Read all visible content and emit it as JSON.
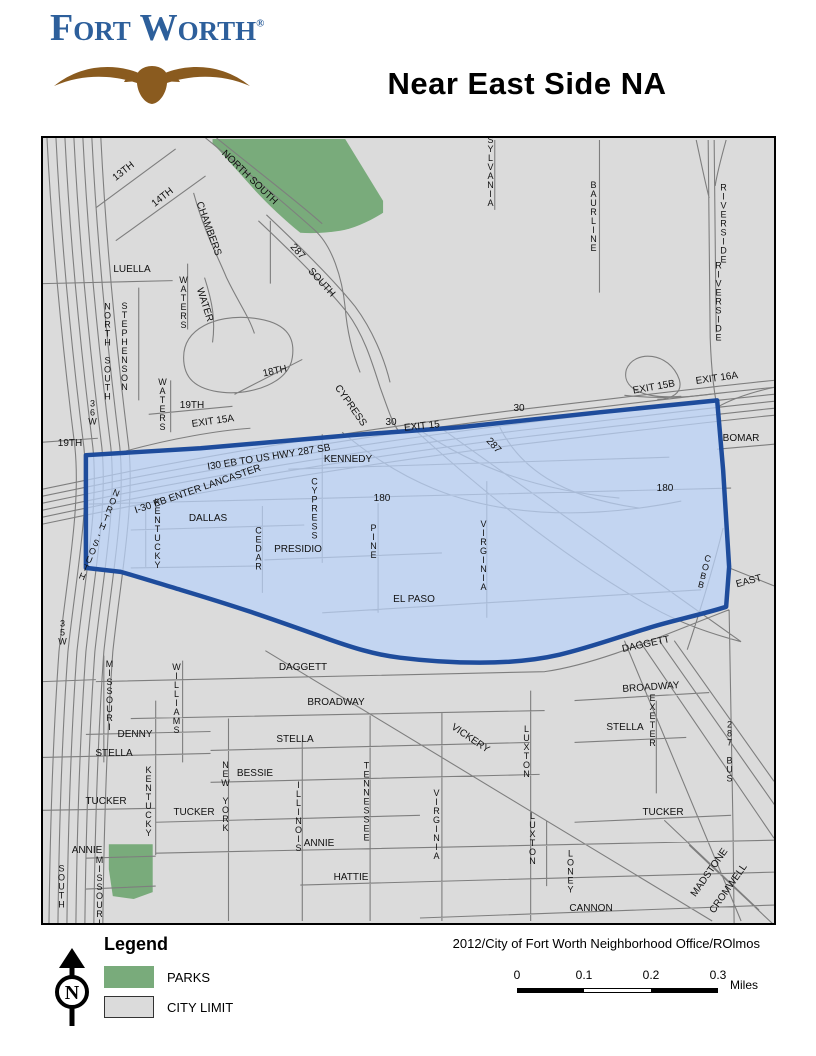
{
  "page": {
    "logo": {
      "text": "Fort Worth",
      "registered": "®"
    },
    "title": "Near East Side NA",
    "attribution": "2012/City of Fort Worth Neighborhood Office/ROlmos"
  },
  "legend": {
    "heading": "Legend",
    "items": [
      {
        "label": "PARKS",
        "color": "#79ab7b"
      },
      {
        "label": "CITY LIMIT",
        "color": "#dbdbdb"
      }
    ]
  },
  "compass": {
    "letter": "N"
  },
  "scalebar": {
    "ticks": [
      "0",
      "0.1",
      "0.2",
      "0.3"
    ],
    "unit": "Miles"
  },
  "map": {
    "neighborhood": "Near East Side",
    "colors": {
      "background": "#dbdbdb",
      "street": "#7e7e7e",
      "park": "#79ab7b",
      "boundary_fill": "rgba(186,210,250,0.72)",
      "boundary_stroke": "#1e4c9c"
    },
    "labels": [
      {
        "t": "13TH",
        "x": 81,
        "y": 34,
        "r": -38
      },
      {
        "t": "14TH",
        "x": 120,
        "y": 60,
        "r": -38
      },
      {
        "t": "CHAMBERS",
        "x": 165,
        "y": 91,
        "r": 70
      },
      {
        "t": "NORTH SOUTH",
        "x": 206,
        "y": 40,
        "r": 44
      },
      {
        "t": "287",
        "x": 254,
        "y": 114,
        "r": 48
      },
      {
        "t": "SOUTH",
        "x": 278,
        "y": 145,
        "r": 48
      },
      {
        "t": "SYLVANIA",
        "x": 447,
        "y": 33,
        "v": true
      },
      {
        "t": "BAURLINE",
        "x": 550,
        "y": 78,
        "v": true
      },
      {
        "t": "RIVERSIDE",
        "x": 680,
        "y": 85,
        "v": true
      },
      {
        "t": "RIVERSIDE",
        "x": 675,
        "y": 163,
        "v": true
      },
      {
        "t": "LUELLA",
        "x": 89,
        "y": 132
      },
      {
        "t": "WATERS",
        "x": 140,
        "y": 164,
        "v": true
      },
      {
        "t": "WATER",
        "x": 161,
        "y": 167,
        "r": 72
      },
      {
        "t": "STEPHENSON",
        "x": 81,
        "y": 208,
        "v": true
      },
      {
        "t": "NORTH SOUTH",
        "x": 64,
        "y": 213,
        "v": true
      },
      {
        "t": "36W",
        "x": 49,
        "y": 274,
        "v": true
      },
      {
        "t": "WATERS",
        "x": 119,
        "y": 266,
        "v": true
      },
      {
        "t": "18TH",
        "x": 232,
        "y": 234,
        "r": -12
      },
      {
        "t": "19TH",
        "x": 149,
        "y": 268
      },
      {
        "t": "19TH",
        "x": 27,
        "y": 306
      },
      {
        "t": "EXIT 15A",
        "x": 170,
        "y": 284,
        "r": -8
      },
      {
        "t": "30",
        "x": 348,
        "y": 285
      },
      {
        "t": "EXIT 15",
        "x": 379,
        "y": 289,
        "r": -6
      },
      {
        "t": "30",
        "x": 476,
        "y": 271
      },
      {
        "t": "EXIT 15B",
        "x": 611,
        "y": 250,
        "r": -10
      },
      {
        "t": "EXIT 16A",
        "x": 674,
        "y": 241,
        "r": -8
      },
      {
        "t": "I-30 EB ENTER LANCASTER",
        "x": 155,
        "y": 352,
        "r": -19
      },
      {
        "t": "I30 EB TO US HWY 287 SB",
        "x": 226,
        "y": 320,
        "r": -9
      },
      {
        "t": "KENNEDY",
        "x": 305,
        "y": 322
      },
      {
        "t": "287",
        "x": 450,
        "y": 308,
        "r": 48
      },
      {
        "t": "180",
        "x": 339,
        "y": 361
      },
      {
        "t": "180",
        "x": 622,
        "y": 351
      },
      {
        "t": "CYPRESS",
        "x": 307,
        "y": 268,
        "r": 55
      },
      {
        "t": "KENTUCKY",
        "x": 114,
        "y": 395,
        "v": true
      },
      {
        "t": "DALLAS",
        "x": 165,
        "y": 381
      },
      {
        "t": "CEDAR",
        "x": 215,
        "y": 410,
        "v": true
      },
      {
        "t": "PRESIDIO",
        "x": 255,
        "y": 412
      },
      {
        "t": "CYPRESS",
        "x": 271,
        "y": 370,
        "v": true
      },
      {
        "t": "PINE",
        "x": 330,
        "y": 403,
        "v": true
      },
      {
        "t": "VIRGINIA",
        "x": 440,
        "y": 417,
        "v": true
      },
      {
        "t": "EL PASO",
        "x": 371,
        "y": 462
      },
      {
        "t": "BOMAR",
        "x": 698,
        "y": 301
      },
      {
        "t": "COBB",
        "x": 661,
        "y": 433,
        "v": true,
        "r": 14
      },
      {
        "t": "EAST",
        "x": 706,
        "y": 444,
        "r": -15
      },
      {
        "t": "NORTH-SOUTH",
        "x": 56,
        "y": 396,
        "v": true,
        "r": 22
      },
      {
        "t": "35W",
        "x": 19,
        "y": 494,
        "v": true
      },
      {
        "t": "DAGGETT",
        "x": 260,
        "y": 530
      },
      {
        "t": "DAGGETT",
        "x": 603,
        "y": 507,
        "r": -12
      },
      {
        "t": "BROADWAY",
        "x": 293,
        "y": 565
      },
      {
        "t": "BROADWAY",
        "x": 608,
        "y": 550,
        "r": -4
      },
      {
        "t": "VICKERY",
        "x": 427,
        "y": 601,
        "r": 34
      },
      {
        "t": "MISSOURI",
        "x": 66,
        "y": 557,
        "v": true
      },
      {
        "t": "WILLIAMS",
        "x": 133,
        "y": 560,
        "v": true
      },
      {
        "t": "DENNY",
        "x": 92,
        "y": 597
      },
      {
        "t": "STELLA",
        "x": 71,
        "y": 616
      },
      {
        "t": "STELLA",
        "x": 252,
        "y": 602
      },
      {
        "t": "STELLA",
        "x": 582,
        "y": 590
      },
      {
        "t": "BESSIE",
        "x": 212,
        "y": 636
      },
      {
        "t": "TUCKER",
        "x": 63,
        "y": 664
      },
      {
        "t": "TUCKER",
        "x": 151,
        "y": 675
      },
      {
        "t": "TUCKER",
        "x": 620,
        "y": 675
      },
      {
        "t": "KENTUCKY",
        "x": 105,
        "y": 663,
        "v": true
      },
      {
        "t": "NEW YORK",
        "x": 182,
        "y": 658,
        "v": true
      },
      {
        "t": "ILLINOIS",
        "x": 255,
        "y": 678,
        "v": true
      },
      {
        "t": "TENNESSEE",
        "x": 323,
        "y": 663,
        "v": true
      },
      {
        "t": "VIRGINIA",
        "x": 393,
        "y": 686,
        "v": true
      },
      {
        "t": "LUXTON",
        "x": 483,
        "y": 613,
        "v": true
      },
      {
        "t": "LUXTON",
        "x": 489,
        "y": 700,
        "v": true
      },
      {
        "t": "LONEY",
        "x": 527,
        "y": 733,
        "v": true
      },
      {
        "t": "EXETER",
        "x": 609,
        "y": 582,
        "v": true
      },
      {
        "t": "287 BUS",
        "x": 686,
        "y": 613,
        "v": true
      },
      {
        "t": "ANNIE",
        "x": 44,
        "y": 713
      },
      {
        "t": "ANNIE",
        "x": 276,
        "y": 706
      },
      {
        "t": "HATTIE",
        "x": 308,
        "y": 740
      },
      {
        "t": "CANNON",
        "x": 548,
        "y": 771
      },
      {
        "t": "MADSTONE",
        "x": 667,
        "y": 735,
        "r": -55
      },
      {
        "t": "CROMWELL",
        "x": 686,
        "y": 751,
        "r": -55
      },
      {
        "t": "MISSOURI",
        "x": 56,
        "y": 753,
        "v": true
      },
      {
        "t": "SOUTH",
        "x": 18,
        "y": 748,
        "v": true
      }
    ]
  }
}
